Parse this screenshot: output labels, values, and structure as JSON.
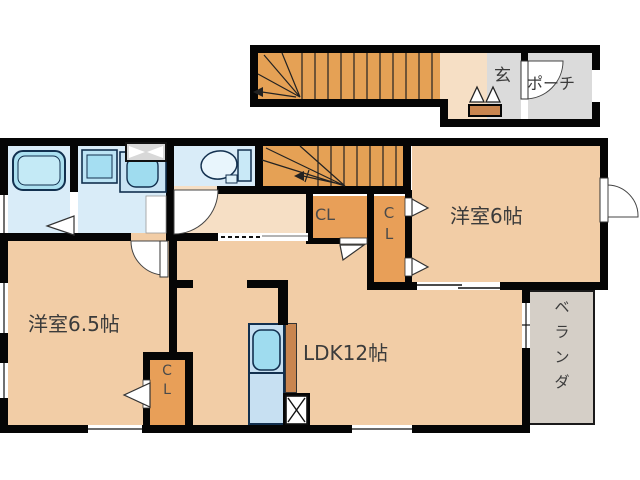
{
  "floorplan": {
    "type": "japanese-apartment-floorplan",
    "labels": {
      "entrance": "玄",
      "porch": "ポーチ",
      "bedroom6": "洋室6帖",
      "bedroom65": "洋室6.5帖",
      "ldk": "LDK12帖",
      "closet": "CL",
      "closet_c": "C",
      "closet_l": "L",
      "veranda": [
        "ベ",
        "ラ",
        "ン",
        "ダ"
      ]
    },
    "colors": {
      "wall": "#050505",
      "room_peach": "#F2CDA6",
      "hall_peach": "#F6DFC5",
      "stairs_orange": "#E5A155",
      "closet_orange": "#E89F58",
      "wetarea_blue": "#D9ECF8",
      "fixture_cyan": "#9FDCEF",
      "entry_gray": "#DBDBDB",
      "balcony_gray": "#D5CFC7",
      "cabinet_brown": "#C9854F",
      "label_text": "#3b3b3b"
    }
  }
}
